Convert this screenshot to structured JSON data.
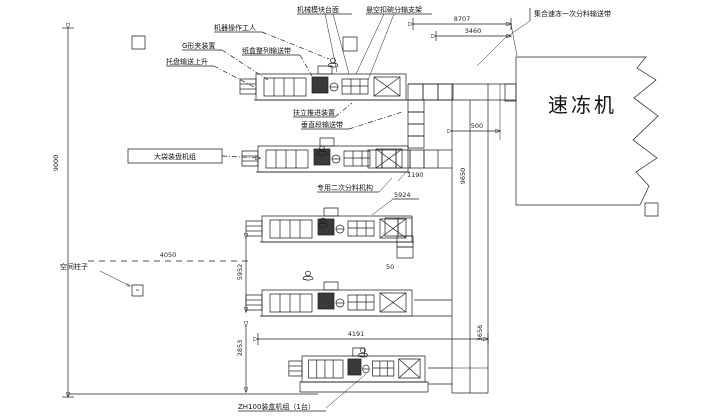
{
  "labels": {
    "module_platform": "机械模块台面",
    "hanging_bracket": "悬空扣碗分输支架",
    "operator": "机器操作工人",
    "g_clamp": "G形夹装置",
    "box_align": "纸盒整列输送带",
    "tray_lift": "托盘输送上升",
    "push_device": "扶立推进装置",
    "vertical_conveyor": "垂直段输送带",
    "big_bag_unit": "大袋装盘机组",
    "secondary_feeder": "专用二次分料机构",
    "freezer_infeed": "集合速冻一次分料输送带",
    "space_column": "空间柱子",
    "bottom_unit": "ZH100装盒机组（1台）",
    "freezer": "速冻机"
  },
  "dimensions": {
    "left_height": "9000",
    "top_total": "8707",
    "top_inner": "3460",
    "gap_500": "500",
    "right_height": "9650",
    "drop_1190": "1190",
    "diag_5924": "5924",
    "offset_4050": "4050",
    "mid_5952": "5952",
    "small_50": "50",
    "bottom_width": "4191",
    "bottom_height": "2853",
    "right_lower": "3656"
  }
}
